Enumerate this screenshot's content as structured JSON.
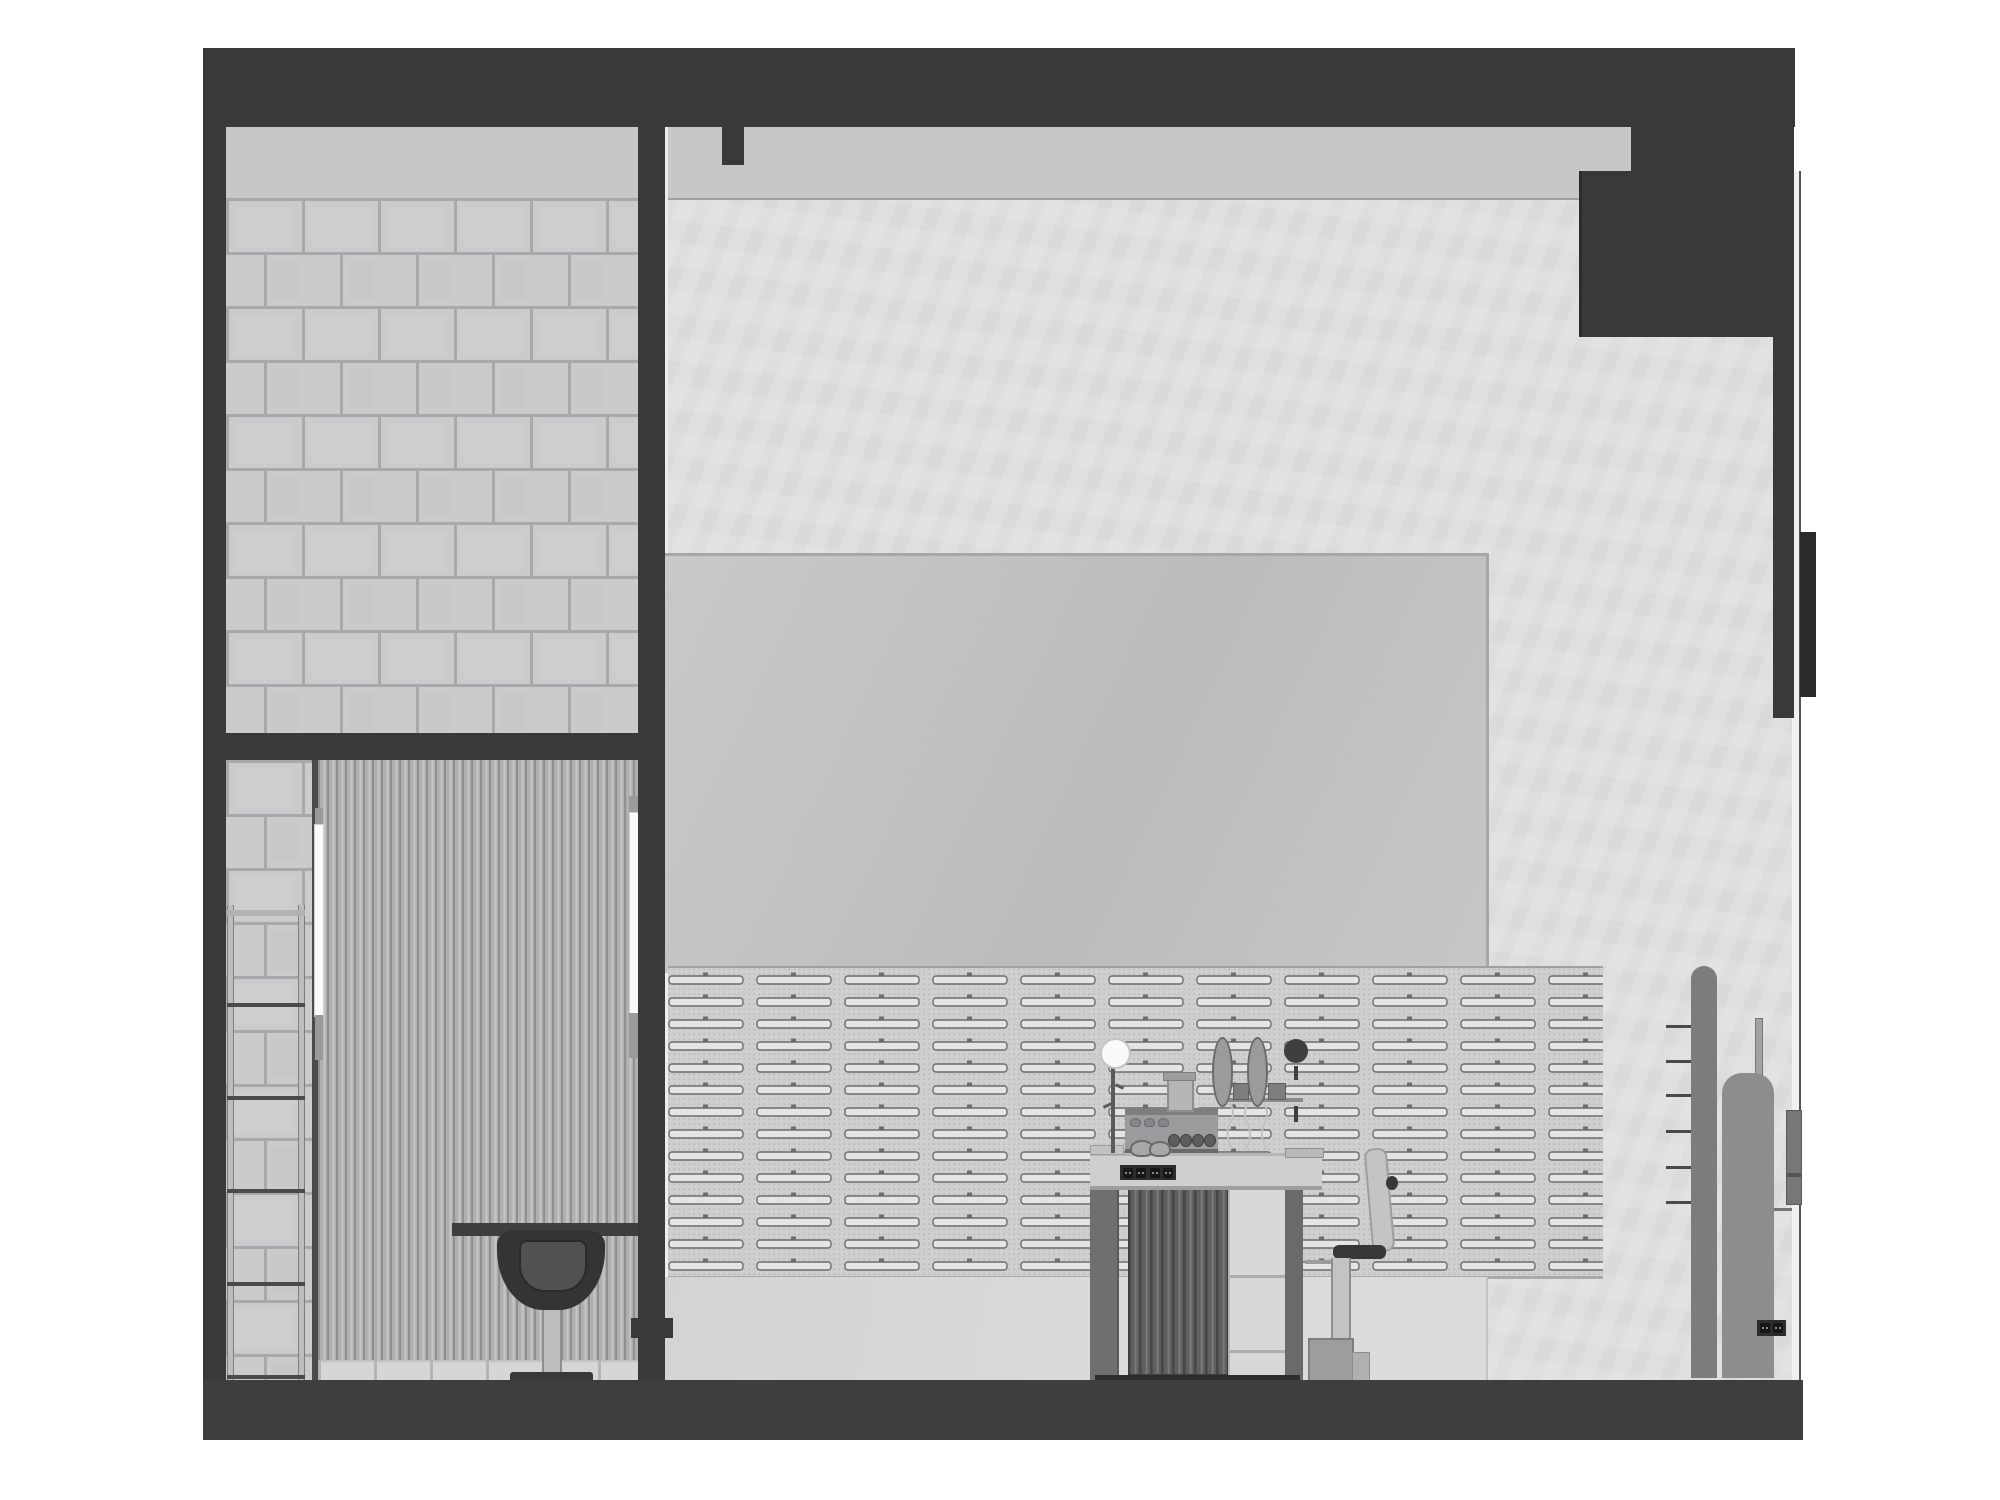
{
  "meta": {
    "title": "Interior section elevation — monochrome architectural render",
    "description": "Sectional elevation of a concrete interior: left bay with CMU block wall, corrugated metal wall, wall table and drafting chair; main bay with smooth concrete band, grey projection panel, perforated slat wall, espresso bar counter with equipment, drafting stool, tall floor-standing units at the right wall.",
    "no_visible_text": true
  },
  "palette": {
    "bg": "#ffffff",
    "frame": "#39393b",
    "floor": "#3e3e40",
    "band": "#c7c7c9",
    "band_line": "#9fa0a2",
    "brick": "#cbcbcd",
    "brick_joint": "#a9a9ab",
    "corru_base": "#b0b0b2",
    "corru_dark": "#8f8f91",
    "corru_light": "#c6c6c8",
    "wall": "#e1e1e3",
    "screen": "#c3c3c5",
    "screen_edge": "#a7a7a9",
    "slat_bg": "#cfcfd1",
    "slat_dot": "#b9b9bb",
    "slat_fill": "#e4e4e6",
    "slat_line": "#6c6c6e",
    "strip_left": "#dadadc",
    "strip_right": "#e0e0e2",
    "strip_seam": "#c2c2c4",
    "plinth": "#d6d6d8",
    "plinth_joint": "#b4b4b6",
    "shutter_base": "#5f5f61",
    "shutter_dark": "#474749",
    "shutter_light": "#7a7a7c",
    "cabinet": "#d8d8da",
    "cabinet_line": "#aeaeb0",
    "bar_side": "#6f6f71",
    "bar_top": "#cfcfd1",
    "bar_top_face": "#d6d6d8",
    "socket": "#2c2c2e",
    "metal": "#9b9b9d",
    "metal_dark": "#6a6a6c",
    "white_light": "#fafafa",
    "light_cap": "#9a9a9c",
    "chair": "#343436",
    "chair_inner": "#515153",
    "pedestal": "#bdbdbf",
    "pole": "#7c7c7e",
    "column2": "#8d8d8f",
    "seat": "#38383a",
    "sphere": "#3f3f41",
    "wall_edge": "#f0f0f0",
    "wall_edge_line": "#565658"
  },
  "left_room": {
    "label": "left bay: block wall over corrugated metal wainscot",
    "ladder": {
      "label": "wall rack ladder",
      "rungs_y": [
        910,
        1003,
        1096,
        1189,
        1282,
        1375
      ]
    },
    "lights": [
      {
        "label": "vertical tube light left",
        "x": 315,
        "tube_top": 824,
        "tube_h": 191
      },
      {
        "label": "vertical tube light right",
        "x": 629,
        "tube_top": 812,
        "tube_h": 201
      }
    ],
    "table": {
      "label": "wall-mounted desk"
    },
    "chair": {
      "label": "drafting chair with pedestal base"
    }
  },
  "main_room": {
    "label": "main bay: concrete wall, grey projection panel, perforated slat wall",
    "screen": {
      "label": "grey wall panel / projection screen"
    },
    "slat_wall": {
      "label": "perforated slat storage wall"
    }
  },
  "bar": {
    "label": "espresso bar counter",
    "sockets_count": 4,
    "portafilters_count": 4,
    "cups_count": 3,
    "items": [
      "globe task lamp",
      "espresso machine with bean hopper",
      "fruit bowls",
      "grinder shelf",
      "two plates on edge",
      "wall-mounted sphere"
    ]
  },
  "stool": {
    "label": "drafting stool with backrest and foot ring"
  },
  "right_unit": {
    "label": "tall floor units at right wall",
    "rack_rungs_y": [
      1025,
      1060,
      1094,
      1130,
      1166,
      1201
    ],
    "outlet_marks": 2
  }
}
